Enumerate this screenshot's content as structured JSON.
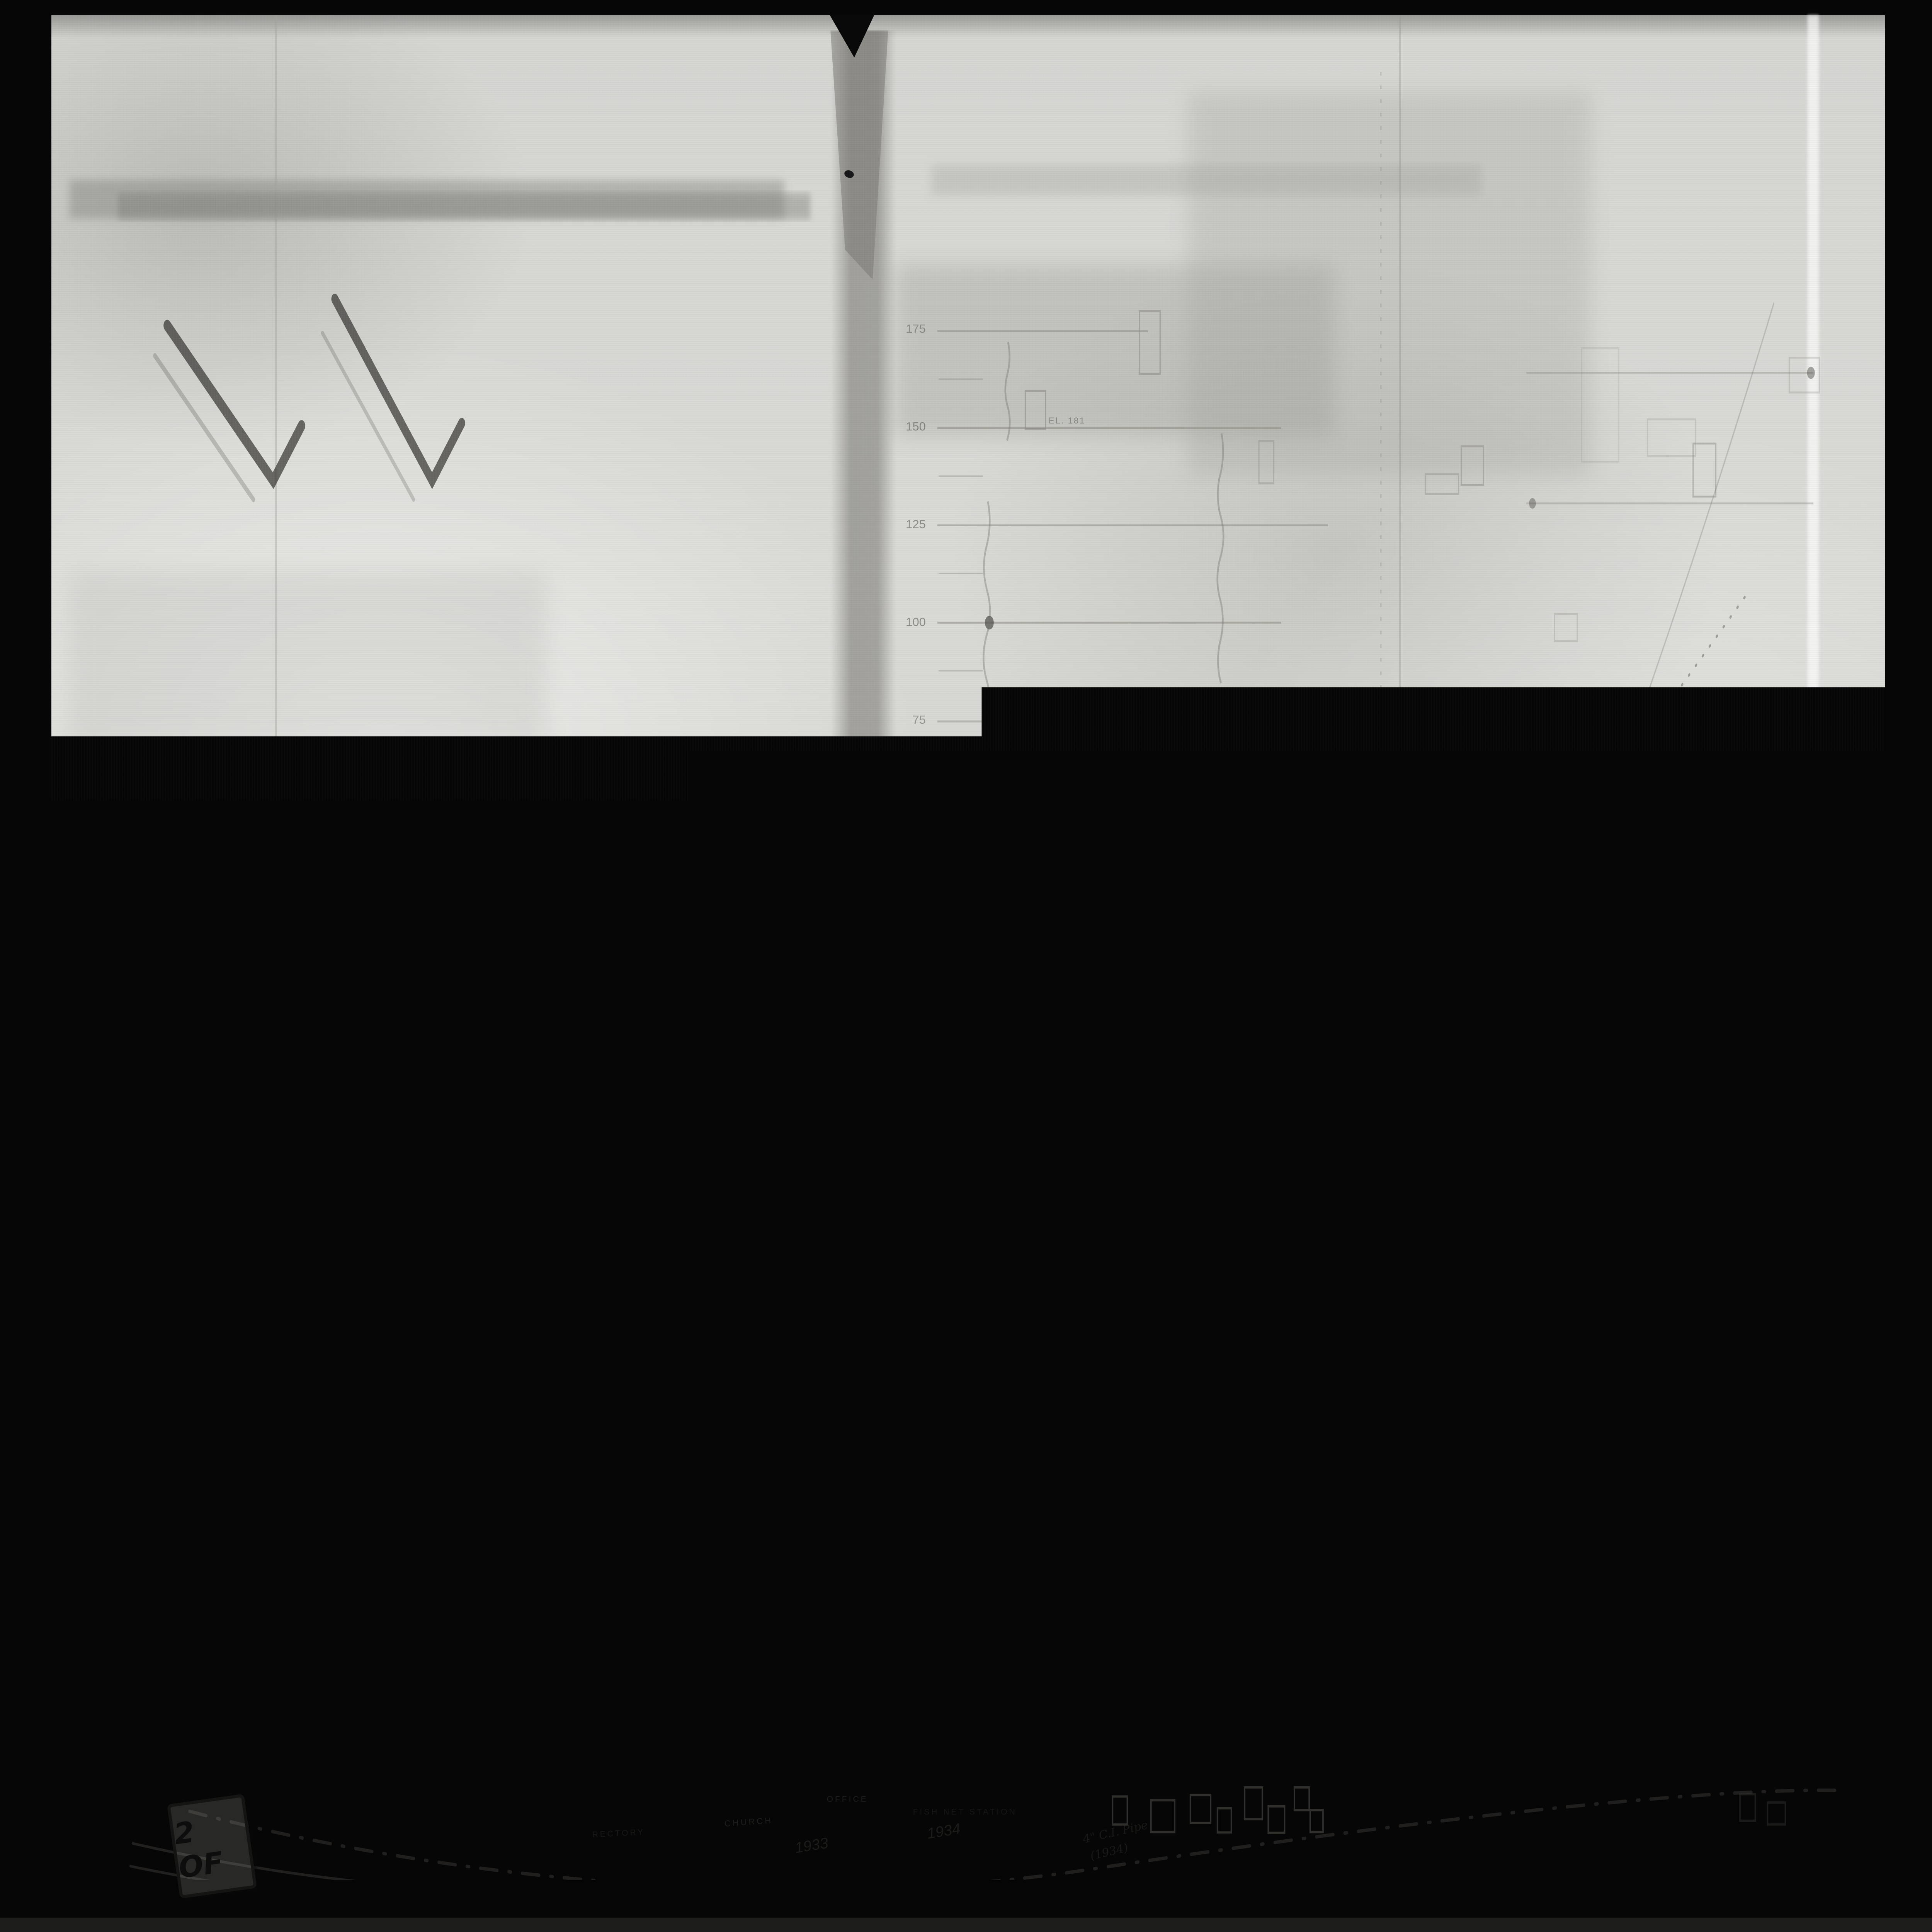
{
  "photo": {
    "stamp": {
      "line1": "POOR",
      "line2": "COPY"
    },
    "page_tag": "2 OF"
  },
  "map": {
    "title": {
      "word1": "LICAN'S",
      "word2": "SYNOD",
      "word3": "PROPERTY"
    },
    "place_label": {
      "ghost1": "I",
      "ghost2": "I",
      "ghost3": "YA",
      "word1": "ALERT",
      "word2": "BAY",
      "word3": "I.R.",
      "word4": "1"
    },
    "boundary_label": "INDIAN RESERVE BOUNDARY",
    "profile": {
      "elevation_ticks": [
        "175",
        "150",
        "125",
        "100",
        "75",
        "50"
      ],
      "spot_elevations": {
        "upper": "EL. 181",
        "lower": "EL. 65"
      }
    },
    "waterfront": {
      "superintendent": "INDIAN SUPERINTENDENT",
      "residence": "RESIDENCE",
      "stores": "STORES",
      "nursing_centre": "NURSING CENTRE",
      "office": "OFFICE",
      "fish_station": "FISH NET STATION",
      "church": "CHURCH",
      "rectory": "RECTORY",
      "shore_year_left": "1933",
      "shore_year_right": "1934",
      "pipe_note": "4\" C.I. Pipe",
      "pipe_note_year": "(1934)"
    }
  }
}
